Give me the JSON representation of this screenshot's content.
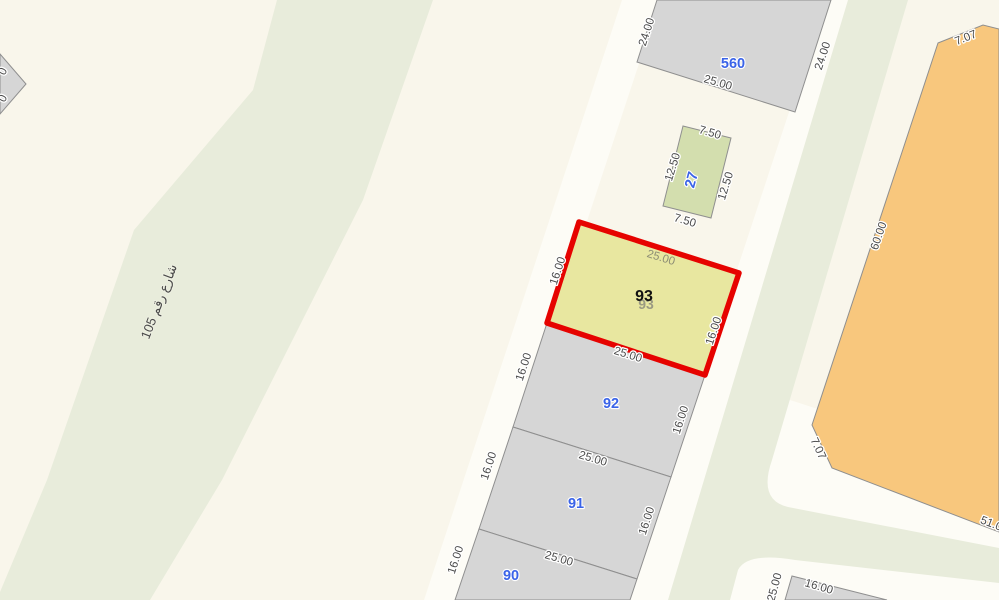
{
  "colors": {
    "background": "#f9f6eb",
    "road_white": "#fdfcf6",
    "street_green": "#e8ecdb",
    "parcel_gray": "#d6d6d6",
    "parcel_border": "#8f8f8f",
    "selected_fill": "#e8e7a0",
    "selected_border": "#e60300",
    "green_parcel_fill": "#d3deae",
    "orange_parcel_fill": "#f8c77d",
    "number_blue": "#3a63e8",
    "dim_gray": "#4a4a4a"
  },
  "street": {
    "name": "شارع رقم 105"
  },
  "parcels": [
    {
      "id": "560",
      "number": "560",
      "dims": {
        "left": "24.00",
        "bottom": "25.00",
        "right": "24.00"
      }
    },
    {
      "id": "27",
      "number": "27",
      "dims": {
        "top": "7.50",
        "left": "12.50",
        "right": "12.50",
        "bottom": "7.50"
      }
    },
    {
      "id": "93",
      "number": "93",
      "ghost_number": "93",
      "selected": true,
      "dims": {
        "top": "25.00",
        "left": "16.00",
        "right": "16.00",
        "bottom": "25.00"
      }
    },
    {
      "id": "92",
      "number": "92",
      "dims": {
        "left": "16.00",
        "right": "16.00",
        "bottom": "25.00"
      }
    },
    {
      "id": "91",
      "number": "91",
      "dims": {
        "left": "16.00",
        "right": "16.00",
        "bottom": "25.00"
      }
    },
    {
      "id": "90",
      "number": "90",
      "dims": {
        "left": "16.00",
        "bottom": "25.00"
      }
    },
    {
      "id": "orange-block",
      "number": "",
      "dims": {
        "top": "7.07",
        "left": "60.00",
        "corner": "7.07",
        "bottom": "51.00"
      }
    },
    {
      "id": "southeast-corner",
      "number": "",
      "dims": {
        "left": "25.00",
        "top": "16.00"
      }
    },
    {
      "id": "northwest-corner",
      "number": "",
      "dims": {
        "a": "0",
        "b": "0"
      }
    }
  ]
}
